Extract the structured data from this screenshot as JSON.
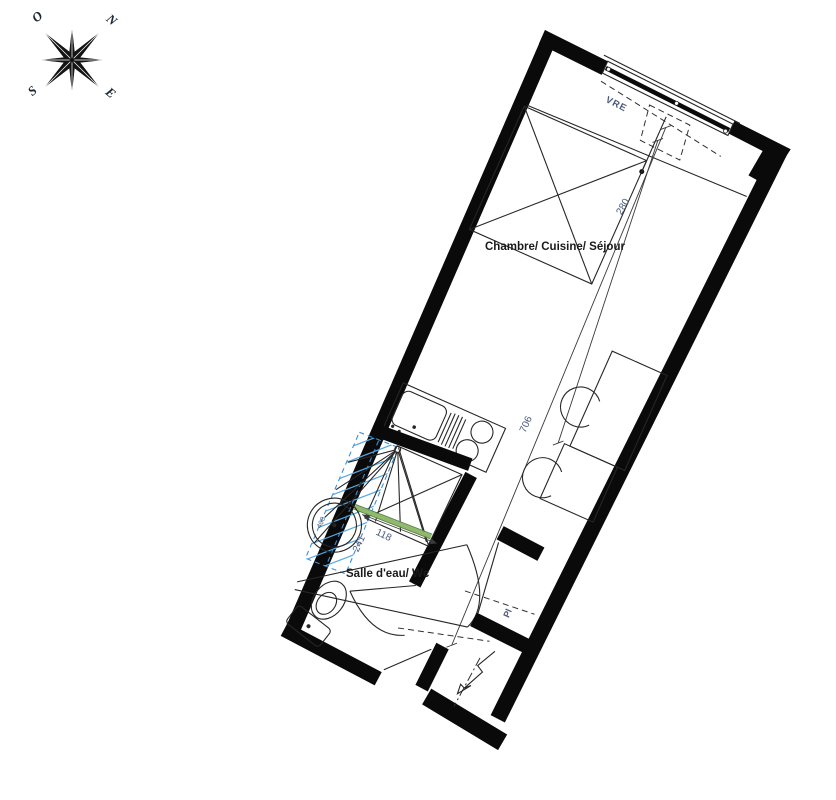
{
  "title": "Plan d'appartement studio",
  "compass": {
    "north": "N",
    "south": "S",
    "east": "E",
    "west": "O"
  },
  "rooms": {
    "main_label": "Chambre/ Cuisine/ Séjour",
    "bathroom_label": "Salle d'eau/ Wc",
    "closet_label": "Pl"
  },
  "window": {
    "label": "VRE"
  },
  "dimensions": {
    "room_width": "280",
    "room_length": "706",
    "bath_width": "118",
    "bath_length": "241",
    "basin_diameter": "400"
  },
  "colors": {
    "wall": "#0a0a0a",
    "line": "#262626",
    "shower_hatch_blue": "#57a8e0",
    "shower_dash_blue": "#3c8fd4",
    "screen_green": "#8fba6e",
    "dimension_text": "#4a5878"
  }
}
